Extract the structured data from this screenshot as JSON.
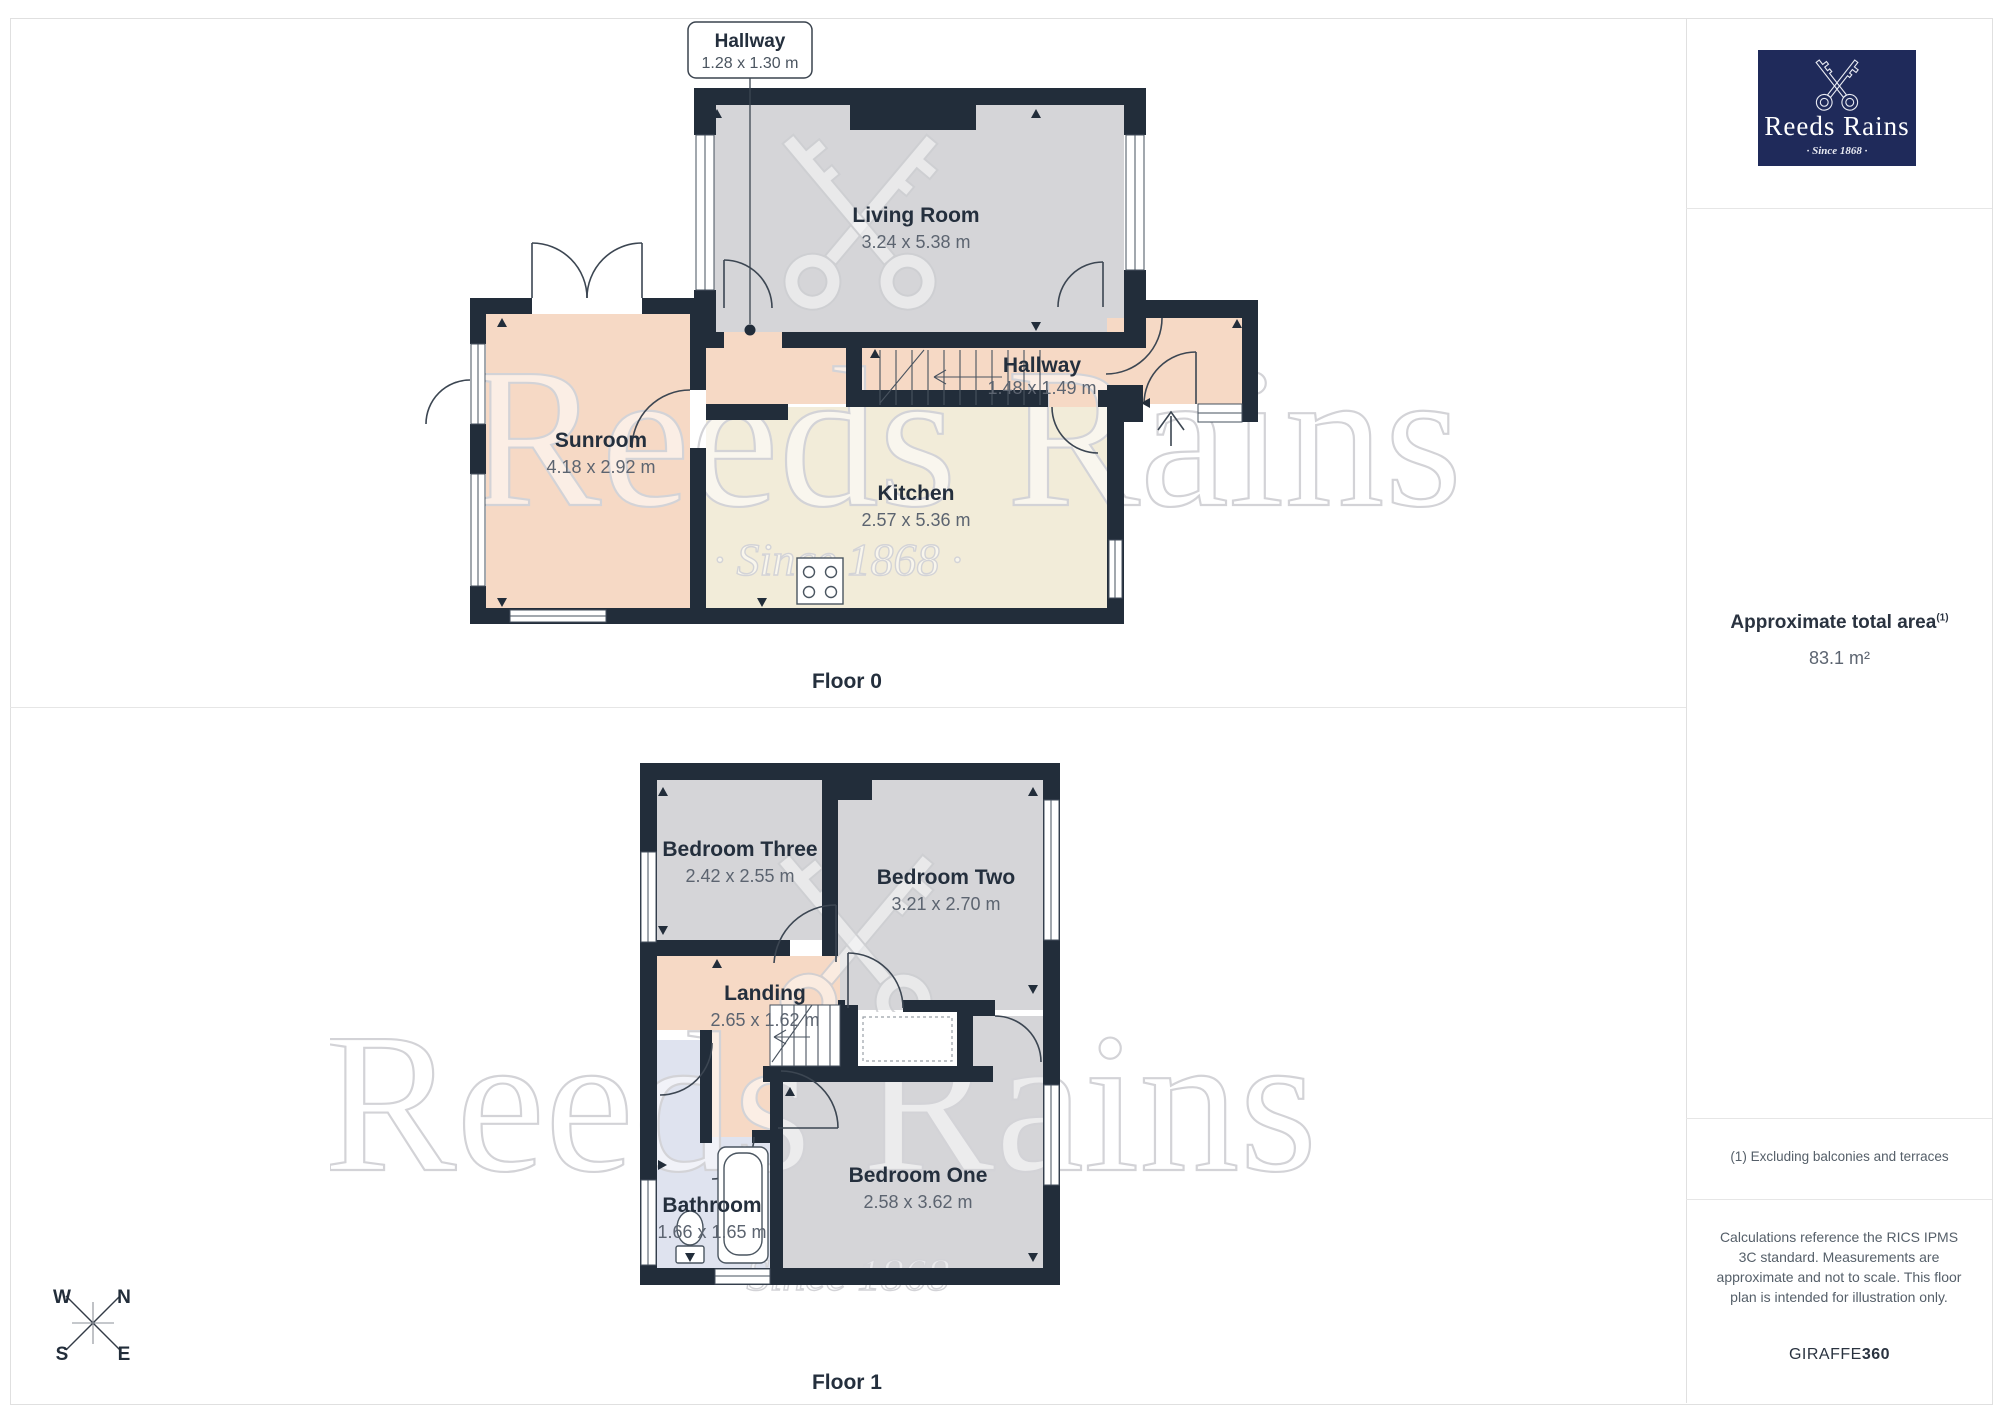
{
  "branding": {
    "logo_title": "Reeds Rains",
    "logo_tagline": "· Since 1868 ·",
    "navy": "#1f2a5a"
  },
  "watermark": {
    "line1": "Reeds Rains",
    "line2": "· Since 1868 ·"
  },
  "sidebar": {
    "area_label": "Approximate total area",
    "area_superscript": "(1)",
    "area_value": "83.1 m²",
    "footnote": "(1) Excluding balconies and terraces",
    "disclaimer": "Calculations reference the RICS IPMS 3C standard. Measurements are approximate and not to scale. This floor plan is intended for illustration only.",
    "brand_regular": "GIRAFFE",
    "brand_bold": "360"
  },
  "floors": {
    "f0": {
      "caption": "Floor 0",
      "callout": {
        "name": "Hallway",
        "dims": "1.28 x 1.30 m"
      },
      "rooms": {
        "living": {
          "name": "Living Room",
          "dims": "3.24 x 5.38 m"
        },
        "hallway": {
          "name": "Hallway",
          "dims": "1.48 x 1.49 m"
        },
        "sunroom": {
          "name": "Sunroom",
          "dims": "4.18 x 2.92 m"
        },
        "kitchen": {
          "name": "Kitchen",
          "dims": "2.57 x 5.36 m"
        }
      }
    },
    "f1": {
      "caption": "Floor 1",
      "rooms": {
        "bedroom_three": {
          "name": "Bedroom Three",
          "dims": "2.42 x 2.55 m"
        },
        "bedroom_two": {
          "name": "Bedroom Two",
          "dims": "3.21 x 2.70 m"
        },
        "landing": {
          "name": "Landing",
          "dims": "2.65 x 1.62 m"
        },
        "bathroom": {
          "name": "Bathroom",
          "dims": "1.66 x 1.65 m"
        },
        "bedroom_one": {
          "name": "Bedroom One",
          "dims": "2.58 x 3.62 m"
        }
      }
    }
  },
  "compass": {
    "north": "N",
    "south": "S",
    "east": "E",
    "west": "W"
  },
  "colors": {
    "wall": "#222d3a",
    "room_gray": "#d5d5d8",
    "room_peach": "#f6d9c5",
    "room_cream": "#f2ecd9",
    "room_blue": "#dfe3ef",
    "logo_navy": "#1f2a5a"
  }
}
